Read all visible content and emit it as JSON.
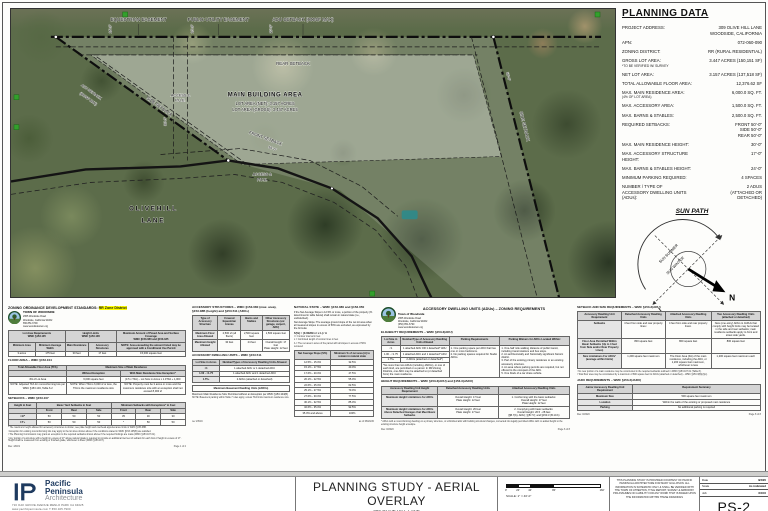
{
  "colors": {
    "highlight": "#ffff00",
    "navy": "#1e3a5f",
    "marker_green": "#33a02c",
    "pool_teal": "#2e8b8b"
  },
  "map": {
    "labels": {
      "equestrian_easement": "EQUESTRIAN EASEMENT",
      "public_utility_easement": "PUBLIC UTILITY EASEMENT",
      "adu_setback_top": "ADU SETBACK (900SF MAX)",
      "rear_setback": "REAR SETBACK",
      "main_building_area": "MAIN BUILDING AREA",
      "lot_area_net": "LOT AREA (NET): 3.157 ACRES",
      "lot_area_gross": "LOT AREA (GROSS): 3.447 ACRES",
      "side_setback_left": "SIDE SETBACK",
      "side_setback_right": "SIDE SETBACK",
      "adu_setback_left_1": "ADU SETBACK",
      "adu_setback_left_2": "(900SF MAX)",
      "front_setback": "FRONT SETBACK",
      "access_pue_1a": "ACCESS &",
      "access_pue_1b": "P.U.E.",
      "access_pue_2a": "ACCESS &",
      "access_pue_2b": "P.U.E.",
      "street_line_1": "O L I V E   H I L L",
      "street_line_2": "L A N E",
      "dim_16": "16'-0\"",
      "dim_20": "20'-0\"",
      "dim_30": "30'-0\"",
      "dim_50_front": "50'-0\"",
      "dim_50_side": "50'-0\""
    }
  },
  "planning": {
    "title": "PLANNING DATA",
    "rows": [
      {
        "l": "PROJECT ADDRESS:",
        "v": "309 OLIVE HILL LANE\nWOODSIDE, CALIFORNIA"
      },
      {
        "l": "APN:",
        "v": "072-060-090"
      },
      {
        "l": "ZONING DISTRICT:",
        "v": "RR (RURAL RESIDENTIAL)"
      },
      {
        "l": "GROSS LOT AREA:",
        "s": "*TO BE VERIFIED W/ SURVEY",
        "v": "3.447 ACRES (150,151 SF)"
      },
      {
        "l": "NET LOT AREA:",
        "v": "3.157 ACRES (137,518 SF)"
      },
      {
        "l": "TOTAL ALLOWABLE FLOOR AREA:",
        "v": "12,376.62 SF"
      },
      {
        "l": "MAX. MAIN RESIDENCE AREA:",
        "s": "(4% OF LOT AREA)",
        "v": "6,000.0 SQ. FT."
      },
      {
        "l": "MAX. ACCESSORY AREA:",
        "v": "1,500.0 SQ. FT."
      },
      {
        "l": "MAX. BARNS & STABLES:",
        "v": "2,500.0 SQ. FT."
      },
      {
        "l": "REQUIRED SETBACKS:",
        "v": "FRONT    50'-0\"\nSIDE    50'-0\"\nREAR    50'-0\""
      },
      {
        "l": "MAX. MAIN RESIDENCE HEIGHT:",
        "v": "30'-0\""
      },
      {
        "l": "MAX. ACCESSORY STRUCTURE HEIGHT:",
        "v": "17'-0\""
      },
      {
        "l": "MAX. BARNS & STABLES HEIGHT:",
        "v": "24'-0\""
      },
      {
        "l": "MINIMUM PARKING REQUIRED:",
        "v": "4 SPACES"
      },
      {
        "l": "NUMBER / TYPE OF\nACCESSORY DWELLING UNITS (ADUs):",
        "v": "2 ADUS\n(ATTACHED OR DETACHED)"
      }
    ]
  },
  "sun": {
    "title": "SUN PATH",
    "north": "N",
    "summer": "SUN SUMMER",
    "winter": "SUN WINTER"
  },
  "docs": {
    "zoning": {
      "header": "ZONING ORDINANCE DEVELOPMENT STANDARDS: ",
      "header_hl": "RR Zone District",
      "org": [
        "TOWN OF WOODSIDE",
        "2955 Woodside Road",
        "Woodside, California 94062",
        "650.851.6790",
        "www.woodsidetown.org"
      ],
      "table1": {
        "widths": [
          "15%",
          "17%",
          "13%",
          "16%",
          "39%"
        ],
        "groups": [
          [
            "Lot Area Requirements\nWMC §153.105",
            2
          ],
          [
            "Height Limits\nWMC §153.106",
            2
          ],
          [
            "Maximum Amount of Paved Area and Surface Coverage\nWMC §153.080 and §153.185",
            1
          ]
        ],
        "header": [
          "Minimum Area",
          "Minimum Average Width",
          "Main Residence",
          "Accessory Structures",
          "NOTE: Area exceeding the amount listed may be approved with a Conditional Use Permit"
        ],
        "rows": [
          [
            "3 acres",
            "175 feet",
            "30 feet",
            "17 feet",
            "15,000 square feet"
          ]
        ]
      },
      "floor_title": "FLOOR AREA – WMC §153.104",
      "floor": {
        "widths": [
          "33%",
          "30%",
          "37%"
        ],
        "groups": [
          [
            "Total Allowable Floor Area (TFA)",
            1
          ],
          [
            "Maximum Size of Main Residence",
            2
          ]
        ],
        "header": [
          "",
          "Without Exception",
          "With Main Residence Size Exception*"
        ],
        "rows": [
          [
            "4% of Lot Area",
            "6,000 square feet",
            "(0.5 x TFA) – Lot Size in Acres x 1.0TFA + 1,000"
          ],
          [
            "NOTE: Adjusted TFA for nonconforming lots per WMC §153.104, Table 6.2",
            "NOTE: When TFA is 6,000 sf or less, the TFA is the maximum residence size",
            "NOTE: Property must be 3 acres or more and the maximum residence size with an exception shall not exceed 8,000 sf"
          ]
        ]
      },
      "setbacks_title": "SETBACKS – WMC §153.107",
      "setbacks": {
        "widths": [
          "16%",
          "14%",
          "14%",
          "14%",
          "14%",
          "14%",
          "14%"
        ],
        "groups": [
          [
            "Height in Feet",
            1
          ],
          [
            "Basic Yard Setbacks in Feet",
            3
          ],
          [
            "Minimum Setbacks with Exceptions* in Feet",
            3
          ]
        ],
        "header": [
          "",
          "Front",
          "Rear",
          "Side",
          "Front",
          "Rear",
          "Side"
        ],
        "labelCol": true,
        "rows": [
          [
            "<17'",
            "50",
            "50",
            "50",
            "35",
            "30",
            "30"
          ],
          [
            "17'+",
            "50",
            "50",
            "50",
            "*",
            "50",
            "50"
          ]
        ]
      },
      "footnotes": [
        "* The maximum height allowed for accessory structures is shown; see plate height and overhead appurtenance limits in WMC §153.08B.",
        "¹ Exception for existing nonconforming lots may apply to the lot sizes shown above if the conditions stated in WMC §153.105(B) are satisfied.",
        "² The Planning Commission may grant an exception to the required setbacks shown above if the required findings are made (WMC §153.107.01).",
        "³ Any portion of a structure with a height in excess of 17' above natural grade is required to provide an additional two feet of setback for each foot of height in excess of 17'. Height shall be measured from existing or finished grade, whichever is lower (WMC §153.107)."
      ],
      "footer_left": "Rev. 4/8/21",
      "footer_right": "Page 1 of 2"
    },
    "accessory": {
      "title": "ACCESSORY STRUCTURES – WMC §153.080 (max. area), §153.08B (height) and §153.511 (ADUs)",
      "table": {
        "widths": [
          "26%",
          "24%",
          "22%",
          "28%"
        ],
        "labelCol": true,
        "header": [
          "Type of Accessory Structure",
          "Covered Equestrian Arenas",
          "Barns and Stables",
          "Other Accessory Structures (ex: garage, carport, ADU)"
        ],
        "rows": [
          [
            "Maximum Floor Area Allowed",
            "2,500 sf (all floors)",
            "2,500 square feet",
            "1,500 square feet"
          ],
          [
            "Maximum Height Allowed",
            "30 feet",
            "24 feet",
            "Overall Height: 17 feet\nPlate Height: 12 feet"
          ]
        ]
      },
      "lot_title": "ACCESSORY DWELLING UNITS – WMC §153.511",
      "lot_table": {
        "widths": [
          "28%",
          "72%"
        ],
        "labelCol": true,
        "header": [
          "Lot Size in Acres",
          "Number/Types of Accessory Dwelling Units Allowed"
        ],
        "rows": [
          [
            "<1",
            "1 attached ADU or 1 detached ADU"
          ],
          [
            "1.00 - <1.75",
            "1 attached ADU and 1 detached ADU"
          ],
          [
            "1.75+",
            "2 ADUs (attached or detached)"
          ]
        ]
      },
      "basement_box": "Maximum Basement Dwelling Units (JADUs)",
      "basement_line": "Maximum Main Residence Size Permitted without an Exception per WMC §153.104(B)",
      "basement_note": "NOTE: Basement parking within Table 7 rules apply, unless TFA limits maximum residence size.",
      "natural_title": "NATURAL STATE – WMC §153.080 and §153.050",
      "natural_text": "If the Net Average Slope is 12.5% or more, a portion of the property (% determined in table below) shall remain in natural state (i.e., undisturbed).",
      "slope_text": "Net Average Slope: The average ground slope of the net lot area when all measured slopes in excess of 50% are excluded, as expressed by the formula:",
      "formula": "S(%) = (0.00229 x I x L) / A",
      "formula_notes": [
        "I = Contour interval in feet",
        "L = Combined length of contour lines in feet",
        "A = The net area in acres of the parcel with all slopes in excess of 50% removed"
      ],
      "slope_table": {
        "widths": [
          "46%",
          "54%"
        ],
        "header": [
          "Net Average Slope (S%)",
          "Minimum % of net area (A) to remain in natural state"
        ],
        "rows": [
          [
            "12.5% - 15.0%",
            "32.5%"
          ],
          [
            "15.1% - 17.5%",
            "40.0%"
          ],
          [
            "17.6% - 20.0%",
            "47.5%"
          ],
          [
            "20.1% - 22.5%",
            "55.0%"
          ],
          [
            "22.6% - 25.0%",
            "62.5%"
          ],
          [
            "25.1% - 27.5%",
            "70.0%"
          ],
          [
            "27.6% - 30.0%",
            "77.5%"
          ],
          [
            "30.1% - 32.5%",
            "85.0%"
          ],
          [
            "32.6% - 35.0%",
            "92.5%"
          ],
          [
            "35.0% and above",
            "100%"
          ]
        ]
      },
      "footer_left": "rev 2/8/19",
      "footer_right": "as of 08/20/20"
    },
    "adu": {
      "title": "ACCESSORY DWELLING UNITS (ADUs) – ZONING REQUIREMENTS",
      "org": [
        "Town of Woodside",
        "2955 Woodside Road",
        "Woodside, California 94062",
        "(650) 851-6790",
        "www.woodsidetown.org"
      ],
      "elig_title": "ELIGIBILITY REQUIREMENTS – WMC §153.3(ADU)",
      "elig": {
        "h1": "Lot Size in Acres",
        "h2": "Number/Type of Accessory Dwelling Units Allowed",
        "h3": "Parking Requirements",
        "h4": "Parking Waivers for ADUs Located Within:",
        "r1a": "<1",
        "r1b": "1 attached ADU OR 1 detached* ADU",
        "r2a": "1.00 - <1.75",
        "r2b": "1 attached ADU and 1 detached* ADU",
        "r3a": "1.75+",
        "r3b": "2 ADUs (attached or detached*)",
        "note": "*No more than two ADUs (including JADUs), or one of each kind, are permitted on a parcel. In RR Zoning Districts, one ADU may be attached to (or detached from) the main residence.",
        "parking": "1.  One parking space per ADU that has one or more bedrooms.\n2.  No parking spaces required for Studio ADUs.",
        "waivers": "1.  One-half mile walking distance of public transit, including transit stations and bus stops.\n2.  An architecturally and historically significant historic district.\n3.  Part of the existing primary residence or an existing accessory structure.\n4.  An area where parking permits are required, but not offered to the occupant of the ADU.\n5.  One block of a car share vehicle."
      },
      "height_title": "HEIGHT REQUIREMENTS – WMC §153.3(ADU) and §153.3(JADU)",
      "height": {
        "widths": [
          "30%",
          "32%",
          "38%"
        ],
        "labelCol": true,
        "header": [
          "Accessory Dwelling Unit Height Requirement",
          "Detached Accessory Dwelling Units",
          "Attached Accessory Dwelling Units"
        ],
        "rows": [
          [
            "Maximum Height Limitations for ADUs",
            "Overall Height: 17 feet\nPlate Height: 12 feet",
            "1. Conforming with the basic setbacks:\nOverall Height: 17 feet\nPlate Height: 12 feet"
          ],
          [
            "Maximum Height Limitations for ADUs Above Detached Garages that Meet Basic Setbacks",
            "Overall Height: 26 feet\nPlate Height: 17 feet",
            "2. Complying with basic setbacks:\nOverall Height: 26.5 - 28 feet\n(§B.7(b), ADU); §(B.7.f); and §153.3 (B.10.b)"
          ]
        ]
      },
      "footnote": "* ADUs with a nonconforming dwelling on a primary structure, or unfinished attic with building structural changes, converted into legally permitted ADUs with no added height to the existing structure height envelope.",
      "footer_left": "Rev. 8/2020",
      "footer_right": "Page 6 of 8"
    },
    "setback": {
      "title": "SETBACK AND SIZE REQUIREMENTS – WMC §153.3(ADU)",
      "table": {
        "widths": [
          "24%",
          "24%",
          "25%",
          "27%"
        ],
        "labelCol": true,
        "header": [
          "Accessory Dwelling Unit Requirement",
          "Detached Accessory Dwelling Units",
          "Attached Accessory Dwelling Units",
          "Two Accessory Dwelling Units (attached or detached)"
        ],
        "rows": [
          [
            "Setbacks",
            "4 feet from side and rear property lines¹",
            "4 feet from side and rear property lines¹",
            "New (one-story) ADUs & JADUs that comply with height limits may be located in the side and rear setbacks; main residence setbacks apply to front and street side yards."
          ],
          [
            "Floor Area Permitted Within Basic Setbacks (Up to 4 feet from Side and/or Rear Property Lines)",
            "800 square feet",
            "800 square feet",
            "800 square feet"
          ],
          [
            "Size Limitations For ADUs² (average within limits)",
            "1,200 square feet maximum",
            "The Floor Area (FA) of the main residence, including the ADU, or 1,200 square feet maximum, whichever is less",
            "1,200 square feet maximum each"
          ]
        ]
      },
      "footnotes": [
        "¹ No new portion of a main residence may be constructed in the required setbacks outlined in WMC §153.107.01 (Table 8).",
        "² Total floor area may be constrained by a maximum of 800 square feet for ADUs (attached or detached) – WMC §153.3(B)(2)(c)."
      ],
      "jadu_title": "JADU REQUIREMENTS – WMC §153.3(JADU)",
      "jadu": {
        "widths": [
          "30%",
          "70%"
        ],
        "labelCol": true,
        "header": [
          "Junior Accessory Dwelling Unit Requirement",
          "Requirement Summary"
        ],
        "rows": [
          [
            "Maximum Size",
            "500 square feet maximum"
          ],
          [
            "Location",
            "Within the walls of the existing or proposed main residence"
          ],
          [
            "Parking",
            "No additional parking is required"
          ]
        ]
      },
      "footer_left": "Rev. 8/2020",
      "footer_right": "Page 8 of 8"
    }
  },
  "titleblock": {
    "firm_line1": "Pacific",
    "firm_line2": "Peninsula",
    "firm_line3": "Architecture",
    "firm_address": "716 OAK GROVE AVENUE   MENLO PARK CA 94025",
    "firm_contact": "www.pacificpeninsula.com   T 650.325.7900",
    "title": "PLANNING STUDY - AERIAL OVERLAY",
    "project_line1": "309 OLIVE HILL LANE",
    "project_line2": "WOODSIDE, CALIFORNIA",
    "scale_ticks": [
      "0'",
      "20'",
      "40'",
      "80'",
      "160'"
    ],
    "scale_label": "SCALE: 1\" = 40'-0\"",
    "disclaimer": "THIS PLANNING STUDY IS PROVIDED COURTESY OF PACIFIC PENINSULA ARCHITECTURE FOR MARY GULLIXSON. ALL INFORMATION IS SCHEMATIC ONLY & SHALL BE VERIFIED WITH THE TOWN OF ATHERTON, TITLE REPORT, SURVEY & ARBORIST. PPA ASSUMES NO LIABILITY FOR ANY WORK THAT IS BASED UPON THE INFORMATION WITHIN THESE DRAWINGS",
    "info": {
      "date_label": "Date",
      "date": "3/3/20",
      "scale_label": "Scale",
      "scale": "As indicated",
      "job_label": "Job",
      "job": "XXXX"
    },
    "sheet_number": "PS-2"
  }
}
